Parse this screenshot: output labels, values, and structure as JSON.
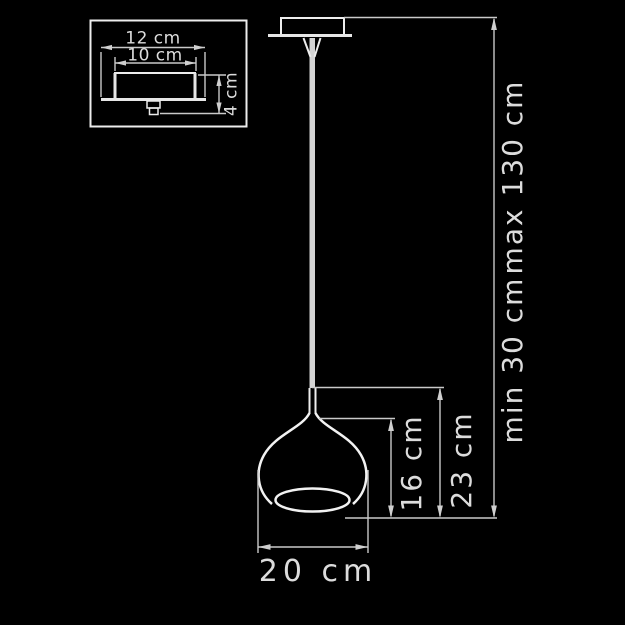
{
  "colors": {
    "background": "#000000",
    "outline": "#ededed",
    "dimension_line": "#c9c9c9",
    "label_text": "#dcdcdc"
  },
  "canopy_detail_inset": {
    "outer_width_label": "12 cm",
    "inner_width_label": "10 cm",
    "height_label": "4 cm"
  },
  "pendant": {
    "shade_diameter_label": "20 cm",
    "glass_height_label": "16 cm",
    "shade_overall_height_label": "23 cm",
    "suspension_min_label": "min 30 cm",
    "suspension_max_label": "max 130 cm"
  }
}
